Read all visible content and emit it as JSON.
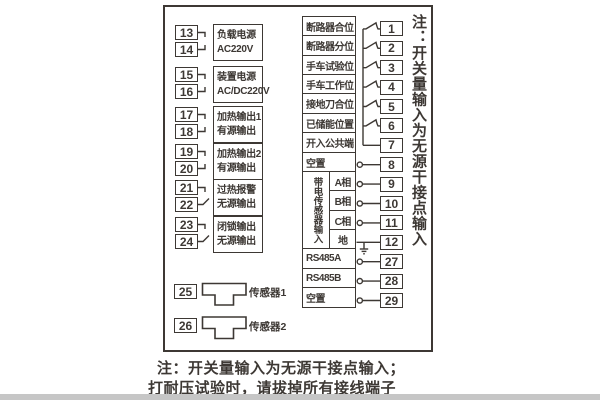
{
  "colors": {
    "line": "#3d3834",
    "background": "#ffffff",
    "bottom_band": "#c6c6c6"
  },
  "left": {
    "pairs": [
      {
        "t1": "13",
        "t2": "14",
        "line1": "负载电源",
        "line2": "AC220V"
      },
      {
        "t1": "15",
        "t2": "16",
        "line1": "装置电源",
        "line2": "AC/DC220V"
      },
      {
        "t1": "17",
        "t2": "18",
        "line1": "加热输出1",
        "line2": "有源输出"
      },
      {
        "t1": "19",
        "t2": "20",
        "line1": "加热输出2",
        "line2": "有源输出"
      },
      {
        "t1": "21",
        "t2": "22",
        "line1": "过热报警",
        "line2": "无源输出"
      },
      {
        "t1": "23",
        "t2": "24",
        "line1": "闭锁输出",
        "line2": "无源输出"
      }
    ]
  },
  "sensors": [
    {
      "t": "25",
      "label": "传感器1"
    },
    {
      "t": "26",
      "label": "传感器2"
    }
  ],
  "right": {
    "block_label": "带电传感器输入",
    "rows": [
      {
        "label": "断路器合位",
        "t": "1"
      },
      {
        "label": "断路器分位",
        "t": "2"
      },
      {
        "label": "手车试验位",
        "t": "3"
      },
      {
        "label": "手车工作位",
        "t": "4"
      },
      {
        "label": "接地刀合位",
        "t": "5"
      },
      {
        "label": "已储能位置",
        "t": "6"
      },
      {
        "label": "开入公共端",
        "t": "7"
      },
      {
        "label": "空置",
        "t": "8"
      },
      {
        "label": "A相",
        "t": "9"
      },
      {
        "label": "B相",
        "t": "10"
      },
      {
        "label": "C相",
        "t": "11"
      },
      {
        "label": "地",
        "t": "12"
      },
      {
        "label": "RS485A",
        "t": "27"
      },
      {
        "label": "RS485B",
        "t": "28"
      },
      {
        "label": "空置",
        "t": "29"
      }
    ]
  },
  "notes": {
    "side_vertical": "注：开关量输入为无源干接点输入",
    "bottom_line1": "注：开关量输入为无源干接点输入；",
    "bottom_line2": "打耐压试验时，请拔掉所有接线端子"
  }
}
